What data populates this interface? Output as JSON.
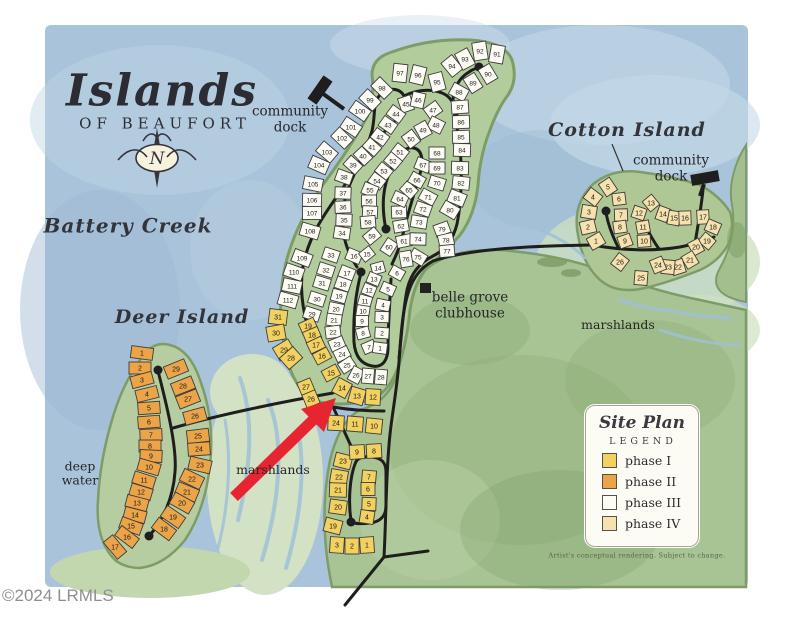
{
  "map": {
    "logo": {
      "main": "Islands",
      "sub": "OF BEAUFORT"
    },
    "labels": {
      "battery_creek": "Battery Creek",
      "deer_island": "Deer Island",
      "cotton_island": "Cotton Island",
      "community_dock_line1": "community",
      "community_dock_line2": "dock",
      "belle_grove_line1": "belle grove",
      "belle_grove_line2": "clubhouse",
      "marshlands": "marshlands",
      "deep_water_line1": "deep",
      "deep_water_line2": "water",
      "compass_n": "N"
    },
    "legend": {
      "title": "Site Plan",
      "subtitle": "LEGEND",
      "items": [
        {
          "label": "phase I",
          "color": "#f2d160"
        },
        {
          "label": "phase II",
          "color": "#eca449"
        },
        {
          "label": "phase III",
          "color": "#fdfcf4"
        },
        {
          "label": "phase IV",
          "color": "#f6e2ae"
        }
      ],
      "note": "Artist's conceptual rendering. Subject to change."
    },
    "watermark": "©2024 LRMLS",
    "phase_colors": {
      "I": "#f2d160",
      "II": "#eca449",
      "III": "#fdfcf4",
      "IV": "#f6e2ae"
    },
    "lot_groups": [
      {
        "name": "p3-outer-west",
        "phase": "III",
        "w": 13,
        "h": 19,
        "lots": [
          [
            98,
            382,
            88
          ],
          [
            99,
            370,
            100
          ],
          [
            100,
            360,
            111
          ],
          [
            101,
            351,
            127
          ],
          [
            102,
            342,
            138
          ],
          [
            103,
            327,
            152
          ],
          [
            104,
            319,
            165
          ],
          [
            105,
            313,
            184
          ],
          [
            106,
            312,
            200
          ],
          [
            107,
            312,
            213
          ]
        ]
      },
      {
        "name": "p3-west-lower",
        "phase": "III",
        "w": 13,
        "h": 19,
        "lots": [
          [
            108,
            310,
            231
          ],
          [
            109,
            302,
            258
          ],
          [
            110,
            294,
            272
          ],
          [
            111,
            292,
            286
          ],
          [
            112,
            288,
            300
          ]
        ]
      },
      {
        "name": "p3-top",
        "phase": "III",
        "w": 14,
        "h": 18,
        "lots": [
          [
            97,
            400,
            73
          ],
          [
            96,
            418,
            75
          ],
          [
            95,
            437,
            82
          ],
          [
            94,
            452,
            66
          ],
          [
            93,
            465,
            59
          ],
          [
            92,
            480,
            51
          ],
          [
            91,
            497,
            54
          ]
        ]
      },
      {
        "name": "p3-east-outer",
        "phase": "III",
        "w": 13,
        "h": 17,
        "lots": [
          [
            90,
            488,
            74
          ],
          [
            89,
            473,
            83
          ],
          [
            88,
            459,
            92
          ],
          [
            87,
            460,
            107
          ],
          [
            86,
            461,
            122
          ],
          [
            85,
            461,
            137
          ],
          [
            84,
            462,
            150
          ],
          [
            83,
            460,
            168
          ],
          [
            82,
            461,
            183
          ],
          [
            81,
            457,
            198
          ],
          [
            80,
            450,
            210
          ]
        ]
      },
      {
        "name": "p3-inner-top",
        "phase": "III",
        "w": 13,
        "h": 15,
        "lots": [
          [
            45,
            406,
            104
          ],
          [
            46,
            418,
            100
          ],
          [
            47,
            433,
            110
          ],
          [
            48,
            436,
            125
          ],
          [
            49,
            423,
            130
          ],
          [
            50,
            411,
            139
          ]
        ]
      },
      {
        "name": "p3-inner-west",
        "phase": "III",
        "w": 12,
        "h": 16,
        "lots": [
          [
            44,
            396,
            114
          ],
          [
            43,
            388,
            125
          ],
          [
            42,
            380,
            137
          ],
          [
            41,
            372,
            147
          ],
          [
            40,
            363,
            156
          ],
          [
            39,
            353,
            165
          ],
          [
            38,
            344,
            177
          ],
          [
            37,
            343,
            193
          ],
          [
            36,
            343,
            207
          ],
          [
            35,
            344,
            220
          ],
          [
            34,
            342,
            233
          ]
        ]
      },
      {
        "name": "p3-mid-a",
        "phase": "III",
        "w": 12,
        "h": 15,
        "lots": [
          [
            51,
            400,
            152
          ],
          [
            52,
            393,
            161
          ],
          [
            53,
            384,
            171
          ],
          [
            54,
            377,
            181
          ],
          [
            55,
            370,
            190
          ],
          [
            56,
            369,
            201
          ],
          [
            57,
            370,
            212
          ],
          [
            58,
            368,
            222
          ],
          [
            59,
            372,
            236
          ],
          [
            60,
            389,
            247
          ]
        ]
      },
      {
        "name": "p3-mid-b",
        "phase": "III",
        "w": 12,
        "h": 15,
        "lots": [
          [
            61,
            404,
            241
          ],
          [
            62,
            401,
            226
          ],
          [
            63,
            399,
            212
          ],
          [
            64,
            400,
            199
          ],
          [
            65,
            409,
            190
          ],
          [
            66,
            417,
            180
          ],
          [
            67,
            423,
            165
          ]
        ]
      },
      {
        "name": "p3-mid-c",
        "phase": "III",
        "w": 12,
        "h": 16,
        "lots": [
          [
            68,
            437,
            153
          ],
          [
            69,
            437,
            168
          ],
          [
            70,
            437,
            183
          ],
          [
            71,
            428,
            197
          ],
          [
            72,
            423,
            209
          ],
          [
            73,
            419,
            222
          ],
          [
            74,
            418,
            239
          ],
          [
            75,
            418,
            257
          ],
          [
            76,
            406,
            259
          ]
        ]
      },
      {
        "name": "p3-east-inner",
        "phase": "III",
        "w": 12,
        "h": 15,
        "lots": [
          [
            79,
            442,
            229
          ],
          [
            78,
            446,
            240
          ],
          [
            77,
            447,
            251
          ]
        ]
      },
      {
        "name": "p3-loop-west-upper",
        "phase": "III",
        "w": 12,
        "h": 16,
        "lots": [
          [
            33,
            331,
            255
          ],
          [
            32,
            326,
            270
          ],
          [
            31,
            322,
            283
          ],
          [
            30,
            317,
            299
          ],
          [
            29,
            312,
            314
          ]
        ]
      },
      {
        "name": "p3-loop-outer",
        "phase": "III",
        "w": 12,
        "h": 15,
        "lots": [
          [
            16,
            354,
            256
          ],
          [
            17,
            347,
            273
          ],
          [
            18,
            343,
            284
          ],
          [
            19,
            339,
            296
          ],
          [
            20,
            336,
            309
          ],
          [
            21,
            334,
            320
          ],
          [
            22,
            333,
            332
          ],
          [
            23,
            337,
            344
          ],
          [
            24,
            342,
            354
          ],
          [
            25,
            347,
            365
          ],
          [
            26,
            356,
            375
          ],
          [
            27,
            368,
            376
          ],
          [
            28,
            381,
            377
          ]
        ]
      },
      {
        "name": "p3-loop-inner-w",
        "phase": "III",
        "w": 11,
        "h": 13,
        "lots": [
          [
            15,
            367,
            254
          ],
          [
            14,
            378,
            268
          ],
          [
            13,
            374,
            279
          ],
          [
            12,
            369,
            290
          ],
          [
            11,
            365,
            301
          ],
          [
            10,
            363,
            311
          ],
          [
            9,
            362,
            321
          ],
          [
            8,
            363,
            333
          ],
          [
            7,
            369,
            347
          ]
        ]
      },
      {
        "name": "p3-loop-inner-e",
        "phase": "III",
        "w": 11,
        "h": 14,
        "lots": [
          [
            6,
            397,
            273
          ],
          [
            5,
            388,
            289
          ],
          [
            4,
            383,
            305
          ],
          [
            3,
            382,
            317
          ],
          [
            2,
            382,
            333
          ],
          [
            1,
            380,
            348
          ]
        ]
      },
      {
        "name": "p1-outer-west",
        "phase": "I",
        "w": 15,
        "h": 18,
        "lots": [
          [
            31,
            278,
            317
          ],
          [
            30,
            276,
            333
          ],
          [
            29,
            284,
            350
          ],
          [
            28,
            291,
            358
          ]
        ]
      },
      {
        "name": "p1-west-strip",
        "phase": "I",
        "w": 12,
        "h": 16,
        "lots": [
          [
            19,
            308,
            326
          ],
          [
            18,
            312,
            335
          ],
          [
            17,
            316,
            345
          ],
          [
            16,
            322,
            356
          ],
          [
            15,
            331,
            373
          ]
        ]
      },
      {
        "name": "p1-27-26",
        "phase": "I",
        "w": 14,
        "h": 14,
        "lots": [
          [
            27,
            306,
            387
          ],
          [
            26,
            311,
            399
          ]
        ]
      },
      {
        "name": "p1-14-12",
        "phase": "I",
        "w": 15,
        "h": 16,
        "lots": [
          [
            14,
            342,
            388
          ],
          [
            13,
            357,
            396
          ],
          [
            12,
            373,
            397
          ]
        ]
      },
      {
        "name": "p1-row-24-10",
        "phase": "I",
        "w": 16,
        "h": 15,
        "lots": [
          [
            24,
            336,
            423
          ],
          [
            11,
            355,
            424
          ],
          [
            10,
            374,
            426
          ]
        ]
      },
      {
        "name": "p1-col-23-19",
        "phase": "I",
        "w": 14,
        "h": 17,
        "lots": [
          [
            23,
            343,
            461
          ],
          [
            22,
            339,
            477
          ],
          [
            21,
            338,
            490
          ],
          [
            20,
            338,
            507
          ],
          [
            19,
            333,
            526
          ]
        ]
      },
      {
        "name": "p1-9-8",
        "phase": "I",
        "w": 15,
        "h": 14,
        "lots": [
          [
            9,
            357,
            452
          ],
          [
            8,
            374,
            451
          ]
        ]
      },
      {
        "name": "p1-col-7-4",
        "phase": "I",
        "w": 13,
        "h": 14,
        "lots": [
          [
            7,
            369,
            477
          ],
          [
            6,
            368,
            489
          ],
          [
            5,
            369,
            504
          ],
          [
            4,
            367,
            517
          ]
        ]
      },
      {
        "name": "p1-row-3-1",
        "phase": "I",
        "w": 14,
        "h": 16,
        "lots": [
          [
            3,
            337,
            545
          ],
          [
            2,
            352,
            546
          ],
          [
            1,
            367,
            545
          ]
        ]
      },
      {
        "name": "p2-deer-west",
        "phase": "II",
        "w": 12,
        "h": 22,
        "lots": [
          [
            1,
            142,
            353
          ],
          [
            2,
            140,
            368
          ],
          [
            3,
            142,
            380
          ],
          [
            4,
            147,
            394
          ],
          [
            5,
            149,
            408
          ],
          [
            6,
            149,
            422
          ],
          [
            7,
            151,
            435
          ],
          [
            8,
            150,
            446
          ],
          [
            9,
            151,
            456
          ],
          [
            10,
            149,
            467
          ],
          [
            11,
            144,
            480
          ],
          [
            12,
            141,
            492
          ],
          [
            13,
            137,
            503
          ],
          [
            14,
            135,
            515
          ],
          [
            15,
            131,
            526
          ],
          [
            16,
            127,
            537
          ],
          [
            17,
            115,
            547
          ]
        ]
      },
      {
        "name": "p2-deer-east",
        "phase": "II",
        "w": 13,
        "h": 22,
        "lots": [
          [
            29,
            176,
            369
          ],
          [
            28,
            183,
            386
          ],
          [
            27,
            188,
            399
          ],
          [
            26,
            195,
            416
          ],
          [
            25,
            198,
            436
          ],
          [
            24,
            199,
            449
          ],
          [
            23,
            200,
            465
          ],
          [
            22,
            192,
            479
          ],
          [
            21,
            187,
            492
          ],
          [
            20,
            182,
            503
          ],
          [
            19,
            173,
            517
          ],
          [
            18,
            164,
            529
          ]
        ]
      },
      {
        "name": "p4-cotton-a",
        "phase": "IV",
        "w": 13,
        "h": 15,
        "lots": [
          [
            5,
            608,
            187
          ],
          [
            4,
            593,
            197
          ],
          [
            3,
            589,
            212
          ],
          [
            2,
            588,
            227
          ],
          [
            1,
            596,
            241
          ]
        ]
      },
      {
        "name": "p4-cotton-b",
        "phase": "IV",
        "w": 12,
        "h": 13,
        "lots": [
          [
            6,
            619,
            199
          ],
          [
            7,
            621,
            215
          ],
          [
            8,
            620,
            227
          ],
          [
            9,
            625,
            241
          ]
        ]
      },
      {
        "name": "p4-cotton-c",
        "phase": "IV",
        "w": 12,
        "h": 13,
        "lots": [
          [
            13,
            651,
            203
          ],
          [
            12,
            639,
            213
          ],
          [
            11,
            643,
            227
          ],
          [
            10,
            644,
            241
          ]
        ]
      },
      {
        "name": "p4-cotton-d",
        "phase": "IV",
        "w": 12,
        "h": 14,
        "lots": [
          [
            14,
            663,
            214
          ],
          [
            15,
            674,
            218
          ],
          [
            16,
            685,
            218
          ],
          [
            17,
            703,
            217
          ]
        ]
      },
      {
        "name": "p4-cotton-e",
        "phase": "IV",
        "w": 12,
        "h": 14,
        "lots": [
          [
            18,
            713,
            227
          ],
          [
            19,
            707,
            241
          ],
          [
            20,
            696,
            247
          ]
        ]
      },
      {
        "name": "p4-cotton-f",
        "phase": "IV",
        "w": 13,
        "h": 14,
        "lots": [
          [
            21,
            690,
            260
          ],
          [
            22,
            678,
            267
          ],
          [
            23,
            668,
            267
          ],
          [
            24,
            658,
            265
          ],
          [
            25,
            641,
            278
          ],
          [
            26,
            620,
            262
          ]
        ]
      }
    ]
  }
}
